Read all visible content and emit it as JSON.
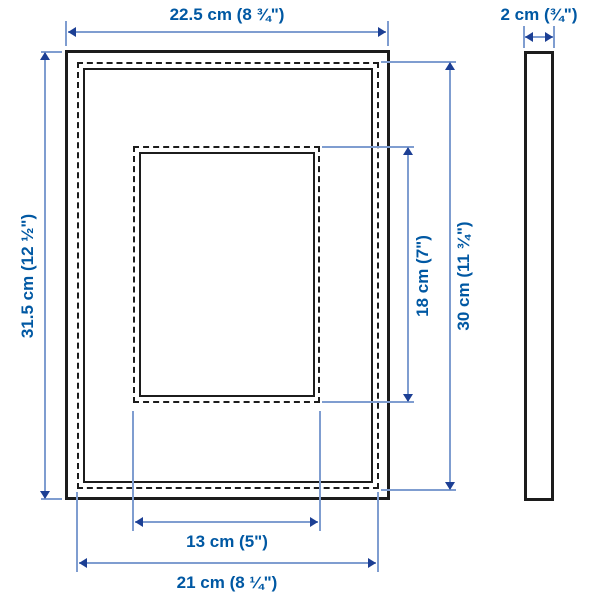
{
  "diagram": {
    "type": "product-dimension-drawing",
    "subject": "picture frame with mat, front view and side view"
  },
  "labels": {
    "outer_width": "22.5 cm (8 ¾\")",
    "depth": "2 cm (¾\")",
    "outer_height": "31.5 cm (12 ½\")",
    "opening_height": "18 cm (7\")",
    "picture_height": "30 cm (11 ¾\")",
    "opening_width": "13 cm (5\")",
    "picture_width": "21 cm (8 ¼\")"
  },
  "measurements": {
    "outer_width_cm": 22.5,
    "depth_cm": 2,
    "outer_height_cm": 31.5,
    "opening_height_cm": 18,
    "picture_height_cm": 30,
    "opening_width_cm": 13,
    "picture_width_cm": 21
  },
  "colors": {
    "outline": "#1c1c1c",
    "dimension_line": "#7f9dd0",
    "arrowhead": "#1c3f94",
    "label_text": "#0058a3",
    "background": "#ffffff"
  }
}
